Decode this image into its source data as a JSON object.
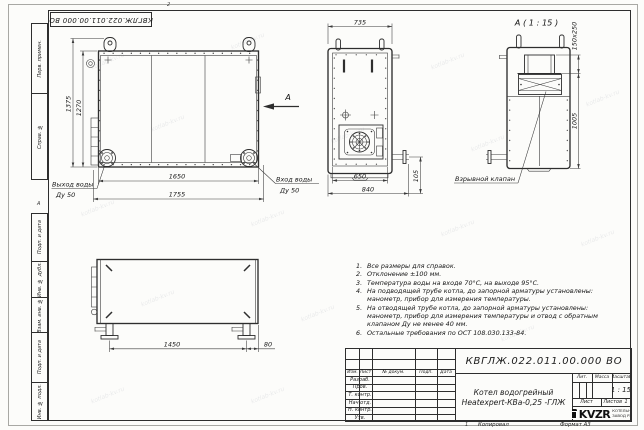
{
  "sheet": {
    "designation": "КВГЛЖ.022.011.00.000 ВО",
    "copied_label": "Копировал",
    "format_label": "Формат А3",
    "watermark": "kotlab-kv.ru",
    "zones": {
      "top": "2",
      "left": "А",
      "bottom": "1"
    }
  },
  "margin_stamps": {
    "perv_primen": "Перв. примен.",
    "sprav_no": "Справ. №",
    "podp_data_1": "Подп. и дата",
    "inv_dubl": "Инв. № дубл.",
    "vzam_inv": "Взам. инв. №",
    "podp_data_2": "Подп. и дата",
    "inv_podl": "Инв. № подл."
  },
  "views": {
    "front": {
      "dims": {
        "height_outer": "1375",
        "height_inner": "1270",
        "width_inner": "1650",
        "width_outer": "1755"
      },
      "outlet_label": "Выход воды",
      "outlet_dn": "Ду 50",
      "inlet_label": "Вход воды",
      "inlet_dn": "Ду 50",
      "view_arrow": "А"
    },
    "side": {
      "dims": {
        "top": "735",
        "bottom_inner": "650",
        "bottom_outer": "840",
        "stub": "105"
      }
    },
    "detail": {
      "title": "А ( 1 : 15 )",
      "dims": {
        "valve_size": "150x250",
        "height": "1005"
      },
      "valve_label": "Взрывной клапан"
    },
    "bottom": {
      "dims": {
        "length": "1450",
        "offset": "80"
      }
    }
  },
  "notes": {
    "items": [
      {
        "num": "1.",
        "text": "Все размеры для справок."
      },
      {
        "num": "2.",
        "text": "Отклонение ±100 мм."
      },
      {
        "num": "3.",
        "text": "Температура воды на входе 70°С, на выходе 95°С."
      },
      {
        "num": "4.",
        "text": "На подводящей трубе котла, до запорной арматуры установлены: манометр, прибор для измерения температуры."
      },
      {
        "num": "5.",
        "text": "На отводящей трубе котла, до запорной арматуры установлены: манометр, прибор для измерения температуры и отвод с обратным клапаном Ду не менее 40 мм."
      },
      {
        "num": "6.",
        "text": "Остальные требования по ОСТ 108.030.133-84."
      }
    ]
  },
  "title_block": {
    "designation": "КВГЛЖ.022.011.00.000 ВО",
    "doc_name_line1": "Котел водогрейный",
    "doc_name_line2": "Heatexpert-КВа-0,25 -ГЛЖ",
    "col_izm": "Изм.",
    "col_list": "Лист",
    "col_docnum": "№ докум.",
    "col_podp": "Подп.",
    "col_data": "Дата",
    "row_razrab": "Разраб.",
    "row_prov": "Пров.",
    "row_tkontr": "Т. контр.",
    "row_nachotd": "Нач.отд.",
    "row_nkontr": "Н. контр.",
    "row_utv": "Утв.",
    "lit_label": "Лит.",
    "mass_label": "Масса",
    "scale_label": "Масштаб",
    "scale_value": "1 : 15",
    "sheet_label": "Лист",
    "sheets_label": "Листов",
    "sheets_value": "1",
    "logo_text": "KVZR",
    "company_line1": "КОТЕЛЬНЫЙ",
    "company_line2": "ЗАВОД РЭП"
  }
}
